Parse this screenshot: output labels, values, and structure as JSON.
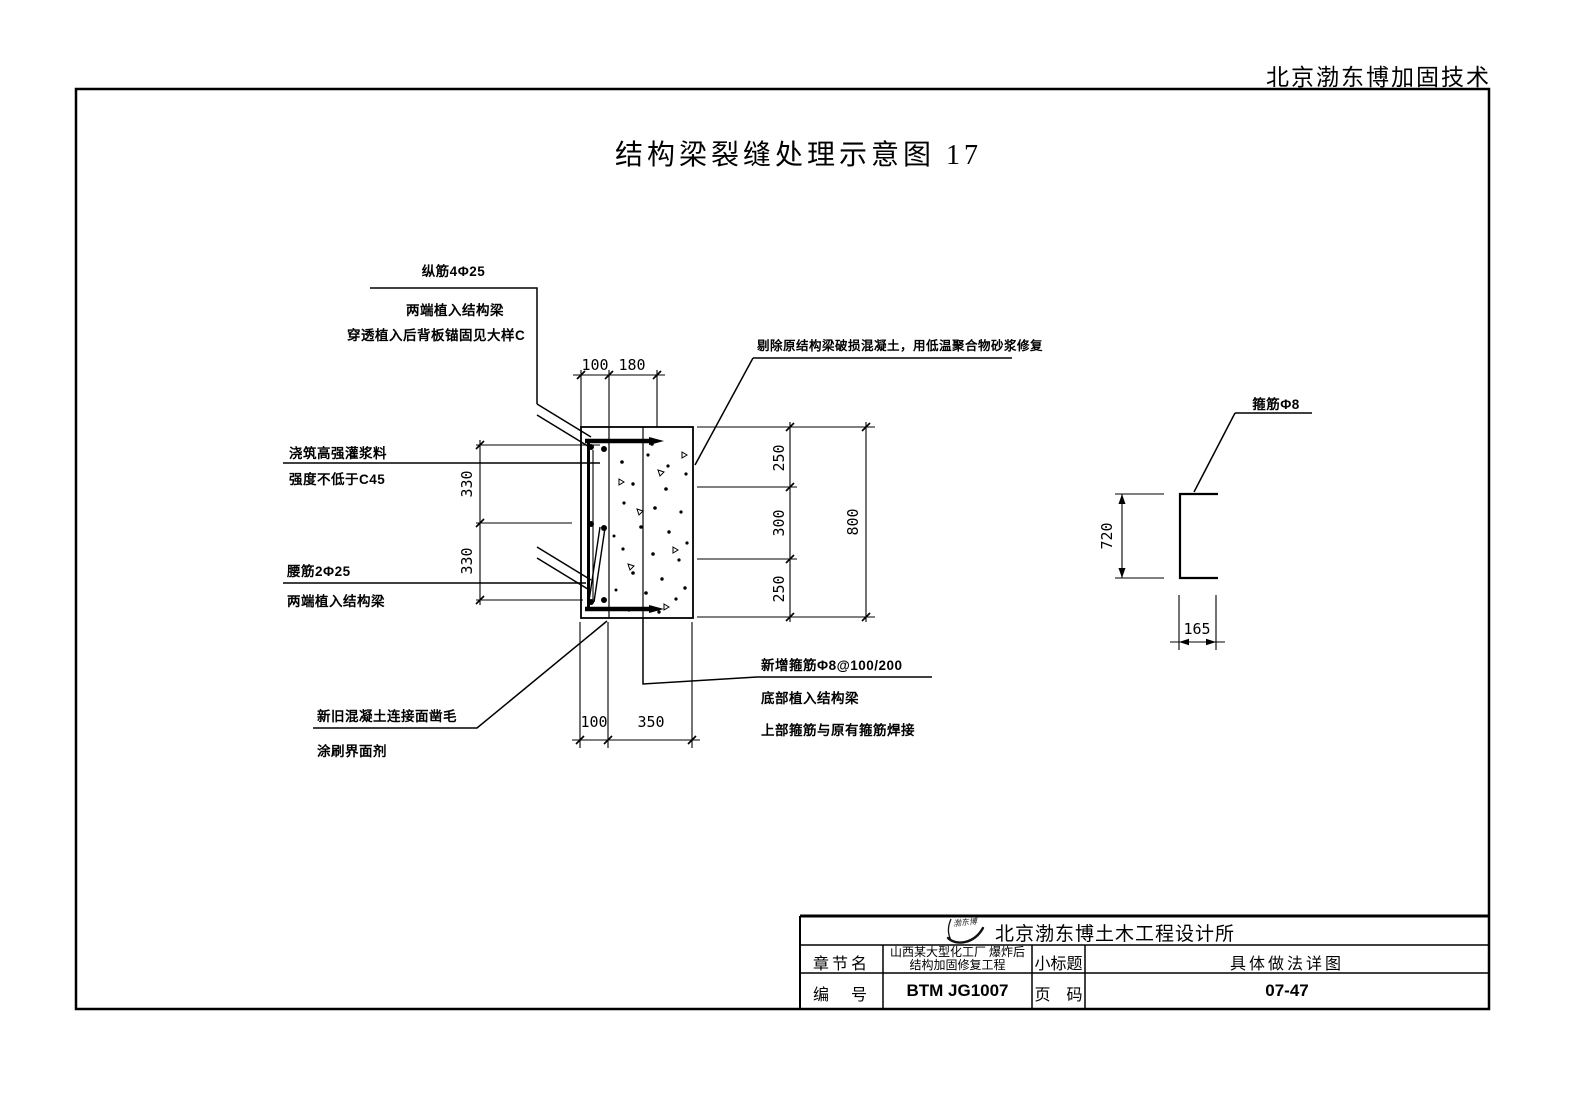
{
  "header": {
    "company_tag": "北京渤东博加固技术"
  },
  "sheet": {
    "title": "结构梁裂缝处理示意图 17"
  },
  "annotations": {
    "zongjin": "纵筋4Φ25",
    "zongjin_note1": "两端植入结构梁",
    "zongjin_note2": "穿透植入后背板锚固见大样C",
    "grout1": "浇筑高强灌浆料",
    "grout2": "强度不低于C45",
    "yaojin": "腰筋2Φ25",
    "yaojin_note": "两端植入结构梁",
    "roughen1": "新旧混凝土连接面凿毛",
    "roughen2": "涂刷界面剂",
    "repair": "剔除原结构梁破损混凝土，用低温聚合物砂浆修复",
    "stirrup_new": "新增箍筋Φ8@100/200",
    "stirrup_note1": "底部植入结构梁",
    "stirrup_note2": "上部箍筋与原有箍筋焊接",
    "stirrup_detail_label": "箍筋Φ8"
  },
  "dimensions": {
    "top": [
      "100",
      "180"
    ],
    "left": [
      "330",
      "330"
    ],
    "right": [
      "250",
      "300",
      "250"
    ],
    "right_total": "800",
    "bottom": [
      "100",
      "350"
    ],
    "detail_height": "720",
    "detail_width": "165"
  },
  "title_block": {
    "logo_text": "渤东博",
    "company": "北京渤东博土木工程设计所",
    "chapter_label": "章节名",
    "project_line1": "山西某大型化工厂 爆炸后",
    "project_line2": "结构加固修复工程",
    "subtitle_label": "小标题",
    "subtitle": "具体做法详图",
    "number_label": "编　号",
    "number": "BTM JG1007",
    "page_label": "页　码",
    "page": "07-47"
  }
}
